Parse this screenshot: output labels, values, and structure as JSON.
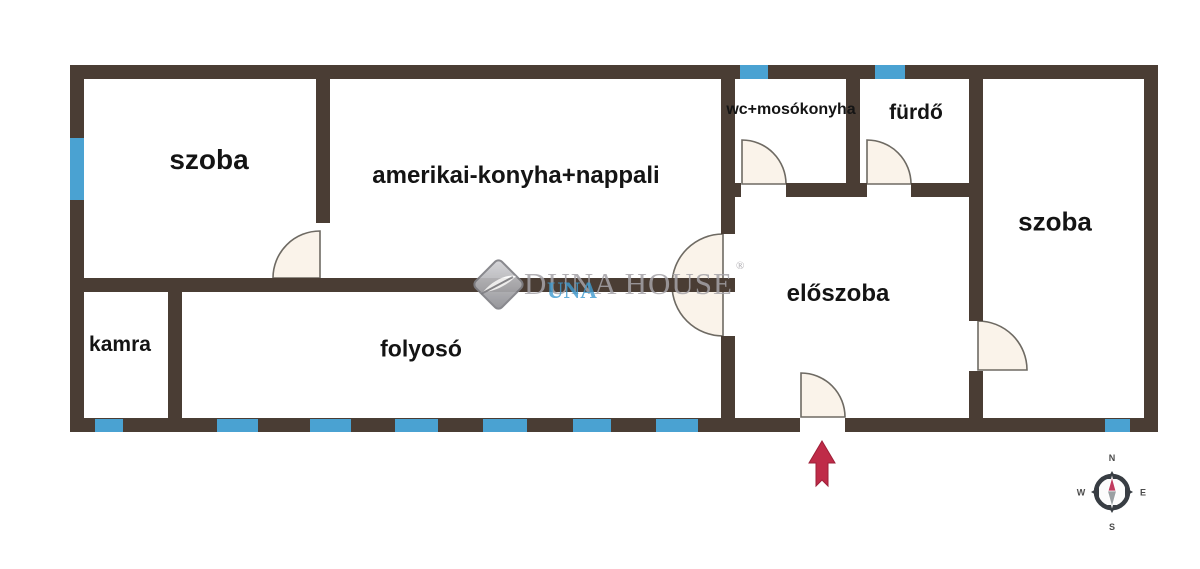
{
  "meta": {
    "type": "apartment-floor-plan"
  },
  "colors": {
    "wall": "#4a3d34",
    "window": "#4aa2d2",
    "door_fill": "#faf3ea",
    "door_stroke": "#6e6a63",
    "label": "#141414",
    "arrow": "#bf2b48",
    "arrow_dark": "#9e1f38",
    "watermark_gray": "#a5a3a8",
    "watermark_blue": "#3f9bd0",
    "compass_ring": "#383d43",
    "compass_red": "#c13b5e",
    "compass_gray": "#9aa0a3",
    "compass_letter": "#4b4b4b"
  },
  "rooms": [
    {
      "id": "szoba-left",
      "label": "szoba",
      "cx": 209,
      "cy": 160,
      "size": 28
    },
    {
      "id": "nappali",
      "label": "amerikai-konyha+nappali",
      "cx": 516,
      "cy": 176,
      "size": 24
    },
    {
      "id": "wc-mosokonyha",
      "label": "wc+mosókonyha",
      "cx": 791,
      "cy": 110,
      "size": 16
    },
    {
      "id": "furdo",
      "label": "fürdő",
      "cx": 916,
      "cy": 113,
      "size": 21
    },
    {
      "id": "szoba-right",
      "label": "szoba",
      "cx": 1055,
      "cy": 222,
      "size": 26
    },
    {
      "id": "eloszoba",
      "label": "előszoba",
      "cx": 838,
      "cy": 294,
      "size": 24
    },
    {
      "id": "kamra",
      "label": "kamra",
      "cx": 120,
      "cy": 345,
      "size": 21
    },
    {
      "id": "folyoso",
      "label": "folyosó",
      "cx": 421,
      "cy": 349,
      "size": 23
    }
  ],
  "plan": {
    "walls": [
      {
        "x": 70,
        "y": 65,
        "w": 1088,
        "h": 14
      },
      {
        "x": 70,
        "y": 65,
        "w": 14,
        "h": 367
      },
      {
        "x": 1144,
        "y": 65,
        "w": 14,
        "h": 367
      },
      {
        "x": 70,
        "y": 418,
        "w": 730,
        "h": 14
      },
      {
        "x": 845,
        "y": 418,
        "w": 313,
        "h": 14
      },
      {
        "x": 316,
        "y": 79,
        "w": 14,
        "h": 144
      },
      {
        "x": 721,
        "y": 79,
        "w": 14,
        "h": 155
      },
      {
        "x": 721,
        "y": 336,
        "w": 14,
        "h": 82
      },
      {
        "x": 846,
        "y": 79,
        "w": 14,
        "h": 104
      },
      {
        "x": 969,
        "y": 79,
        "w": 14,
        "h": 242
      },
      {
        "x": 969,
        "y": 371,
        "w": 14,
        "h": 47
      },
      {
        "x": 70,
        "y": 278,
        "w": 665,
        "h": 14
      },
      {
        "x": 168,
        "y": 278,
        "w": 14,
        "h": 140
      },
      {
        "x": 721,
        "y": 183,
        "w": 20,
        "h": 14
      },
      {
        "x": 786,
        "y": 183,
        "w": 81,
        "h": 14
      },
      {
        "x": 911,
        "y": 183,
        "w": 58,
        "h": 14
      }
    ],
    "windows": [
      {
        "x": 70,
        "y": 138,
        "w": 14,
        "h": 62
      },
      {
        "x": 740,
        "y": 65,
        "w": 28,
        "h": 14
      },
      {
        "x": 875,
        "y": 65,
        "w": 30,
        "h": 14
      },
      {
        "x": 95,
        "y": 419,
        "w": 28,
        "h": 13
      },
      {
        "x": 217,
        "y": 419,
        "w": 41,
        "h": 13
      },
      {
        "x": 310,
        "y": 419,
        "w": 41,
        "h": 13
      },
      {
        "x": 395,
        "y": 419,
        "w": 43,
        "h": 13
      },
      {
        "x": 483,
        "y": 419,
        "w": 44,
        "h": 13
      },
      {
        "x": 573,
        "y": 419,
        "w": 38,
        "h": 13
      },
      {
        "x": 656,
        "y": 419,
        "w": 42,
        "h": 13
      },
      {
        "x": 1105,
        "y": 419,
        "w": 25,
        "h": 13
      }
    ],
    "doors": [
      {
        "name": "door-szoba-left",
        "path": "M320,278 L320,231 A47,47 0 0 0 273,278 Z"
      },
      {
        "name": "door-wc-mosokonyha",
        "path": "M742,184 L742,140 A44,44 0 0 1 786,184 Z"
      },
      {
        "name": "door-furdo",
        "path": "M867,184 L867,140 A44,44 0 0 1 911,184 Z"
      },
      {
        "name": "door-eloszoba-double",
        "path": "M723,234 A51,51 0 0 0 723,336 Z"
      },
      {
        "name": "door-szoba-right",
        "path": "M978,370 L978,321 A49,49 0 0 1 1027,370 Z"
      },
      {
        "name": "door-entrance",
        "path": "M801,417 L801,373 A44,44 0 0 1 845,417 Z"
      }
    ],
    "entrance_arrow": {
      "points": "822,441 835,463 828,463 828,486 822,480 816,486 816,463 809,463"
    },
    "compass": {
      "cx": 1112,
      "cy": 492,
      "labels": {
        "n": "N",
        "e": "E",
        "s": "S",
        "w": "W"
      }
    }
  },
  "watermark": {
    "text": "DUNA HOUSE",
    "accent": "UNA",
    "registered": "®"
  }
}
